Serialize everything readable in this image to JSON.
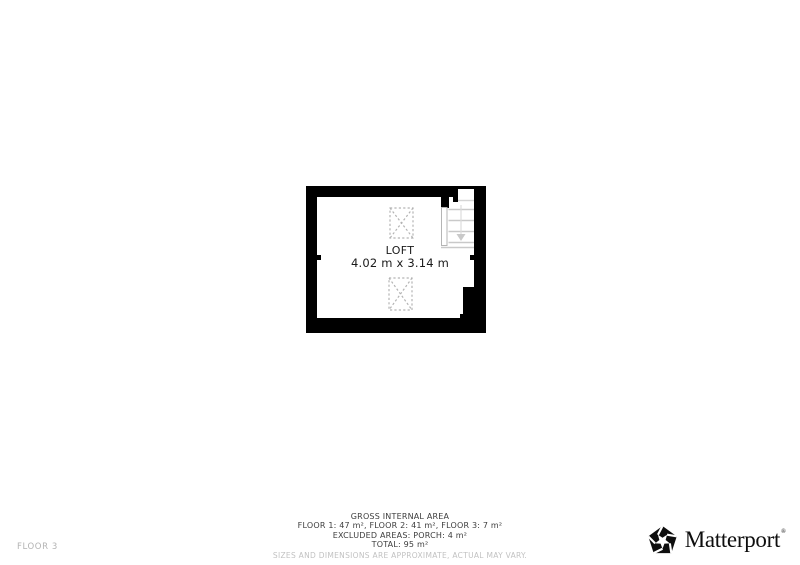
{
  "page": {
    "background": "#ffffff"
  },
  "plan": {
    "room_label": "LOFT",
    "room_size": "4.02 m x 3.14 m",
    "wall_color": "#000000",
    "stair_line_color": "#c9c9c9",
    "stair_arrow_color": "#cccccc",
    "skylight_outline_color": "#b3b3b3"
  },
  "footer": {
    "area_summary": {
      "title": "GROSS INTERNAL AREA",
      "floors_line": "FLOOR 1: 47 m², FLOOR 2: 41 m², FLOOR 3: 7 m²",
      "excluded_line": "EXCLUDED AREAS: PORCH: 4 m²",
      "total_line": "TOTAL: 95 m²",
      "disclaimer": "SIZES AND DIMENSIONS ARE APPROXIMATE, ACTUAL MAY VARY."
    },
    "floor_indicator": "FLOOR 3"
  },
  "brand": {
    "name": "Matterport",
    "registered_mark": "®"
  }
}
